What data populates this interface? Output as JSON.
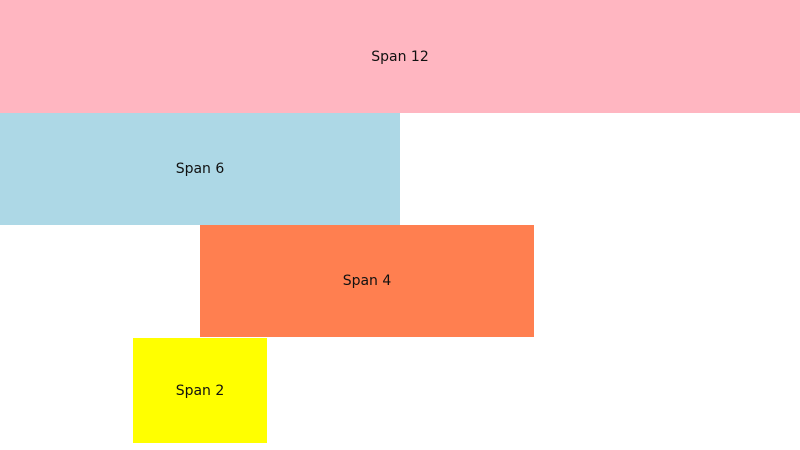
{
  "page": {
    "background_color": "#FFFFFF",
    "text_color": "#111111"
  },
  "grid_demo": {
    "blocks": [
      {
        "label": "Span 12",
        "span": 12,
        "color": "#FFB6C1"
      },
      {
        "label": "Span 6",
        "span": 6,
        "color": "#ADD8E6"
      },
      {
        "label": "Span 4",
        "span": 4,
        "color": "#FF7F50"
      },
      {
        "label": "Span 2",
        "span": 2,
        "color": "#FFFF00"
      }
    ]
  }
}
